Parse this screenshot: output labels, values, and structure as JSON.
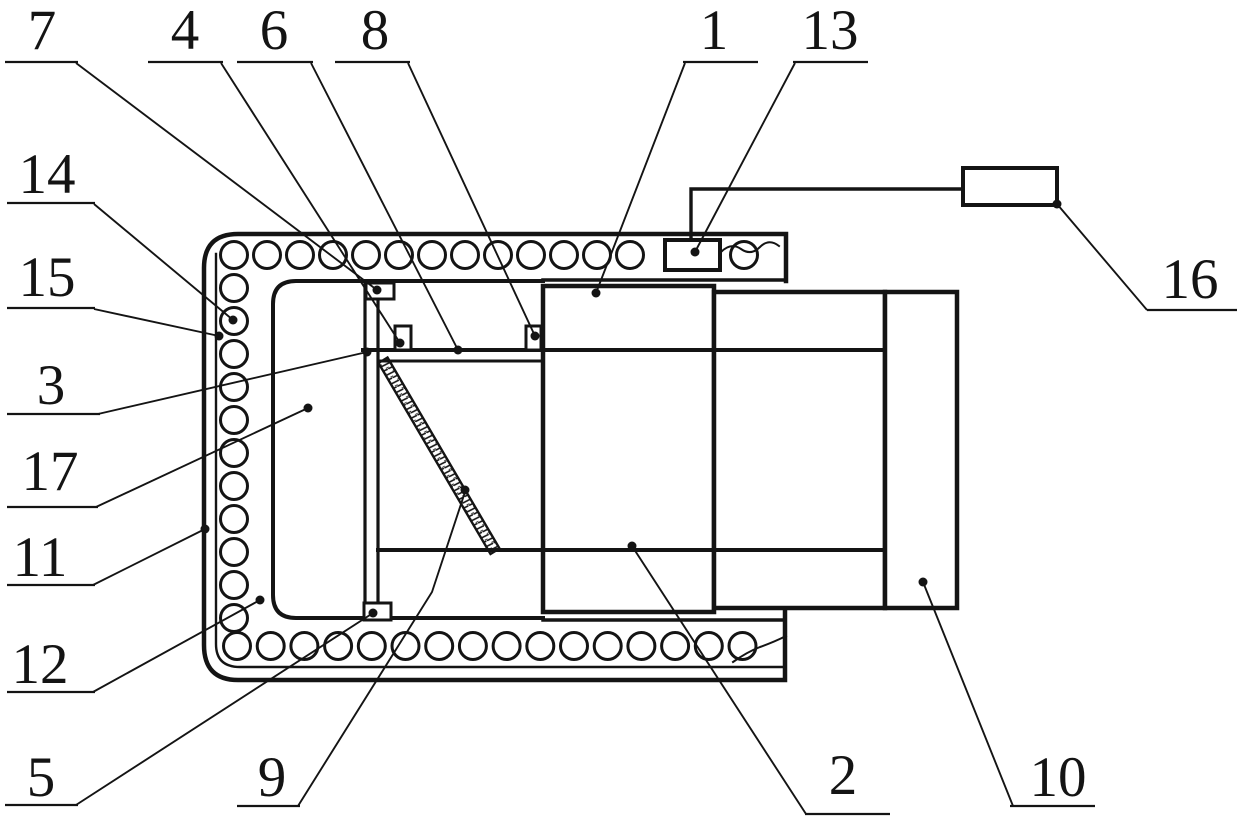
{
  "figure": {
    "kind": "patent-technical-drawing",
    "background_color": "#ffffff",
    "line_color": "#141414",
    "reference_numerals": [
      "1",
      "2",
      "3",
      "4",
      "5",
      "6",
      "7",
      "8",
      "9",
      "10",
      "11",
      "12",
      "13",
      "14",
      "15",
      "16",
      "17"
    ]
  },
  "labels": [
    {
      "ref": "7",
      "tx": 42,
      "ty": 49,
      "u": [
        5,
        78,
        62
      ],
      "leader": [
        [
          76,
          63
        ],
        [
          377,
          290
        ]
      ],
      "dot": [
        377,
        290
      ]
    },
    {
      "ref": "4",
      "tx": 185,
      "ty": 49,
      "u": [
        148,
        223,
        62
      ],
      "leader": [
        [
          221,
          63
        ],
        [
          400,
          343
        ]
      ],
      "dot": [
        400,
        343
      ]
    },
    {
      "ref": "6",
      "tx": 274,
      "ty": 49,
      "u": [
        237,
        313,
        62
      ],
      "leader": [
        [
          311,
          63
        ],
        [
          458,
          350
        ]
      ],
      "dot": [
        458,
        350
      ]
    },
    {
      "ref": "8",
      "tx": 375,
      "ty": 49,
      "u": [
        335,
        410,
        62
      ],
      "leader": [
        [
          408,
          63
        ],
        [
          535,
          336
        ]
      ],
      "dot": [
        535,
        336
      ]
    },
    {
      "ref": "1",
      "tx": 714,
      "ty": 49,
      "u": [
        683,
        758,
        62
      ],
      "leader": [
        [
          685,
          63
        ],
        [
          596,
          293
        ]
      ],
      "dot": [
        596,
        293
      ]
    },
    {
      "ref": "13",
      "tx": 830,
      "ty": 49,
      "u": [
        793,
        868,
        62
      ],
      "leader": [
        [
          795,
          63
        ],
        [
          695,
          252
        ]
      ],
      "dot": [
        695,
        252
      ]
    },
    {
      "ref": "14",
      "tx": 47,
      "ty": 193,
      "u": [
        7,
        95,
        203
      ],
      "leader": [
        [
          94,
          204
        ],
        [
          233,
          320
        ]
      ],
      "dot": [
        233,
        320
      ]
    },
    {
      "ref": "15",
      "tx": 47,
      "ty": 296,
      "u": [
        7,
        95,
        308
      ],
      "leader": [
        [
          94,
          309
        ],
        [
          219,
          336
        ]
      ],
      "dot": [
        219,
        336
      ]
    },
    {
      "ref": "3",
      "tx": 51,
      "ty": 404,
      "u": [
        7,
        100,
        414
      ],
      "leader": [
        [
          98,
          414
        ],
        [
          367,
          352
        ]
      ],
      "dot": [
        367,
        352
      ]
    },
    {
      "ref": "17",
      "tx": 50,
      "ty": 490,
      "u": [
        7,
        98,
        507
      ],
      "leader": [
        [
          96,
          507
        ],
        [
          308,
          408
        ]
      ],
      "dot": [
        308,
        408
      ]
    },
    {
      "ref": "11",
      "tx": 40,
      "ty": 576,
      "u": [
        7,
        95,
        585
      ],
      "leader": [
        [
          93,
          585
        ],
        [
          205,
          529
        ]
      ],
      "dot": [
        205,
        529
      ]
    },
    {
      "ref": "12",
      "tx": 40,
      "ty": 683,
      "u": [
        7,
        95,
        692
      ],
      "leader": [
        [
          93,
          692
        ],
        [
          260,
          600
        ]
      ],
      "dot": [
        260,
        600
      ]
    },
    {
      "ref": "5",
      "tx": 41,
      "ty": 796,
      "u": [
        5,
        78,
        805
      ],
      "leader": [
        [
          76,
          805
        ],
        [
          373,
          613
        ]
      ],
      "dot": [
        373,
        613
      ]
    },
    {
      "ref": "9",
      "tx": 272,
      "ty": 796,
      "u": [
        237,
        300,
        806
      ],
      "leader": [
        [
          298,
          806
        ],
        [
          432,
          592
        ],
        [
          465,
          492
        ]
      ],
      "dot": [
        465,
        490
      ]
    },
    {
      "ref": "2",
      "tx": 843,
      "ty": 794,
      "u": [
        805,
        890,
        814
      ],
      "leader": [
        [
          806,
          814
        ],
        [
          632,
          546
        ]
      ],
      "dot": [
        632,
        546
      ]
    },
    {
      "ref": "10",
      "tx": 1058,
      "ty": 796,
      "u": [
        1010,
        1095,
        806
      ],
      "leader": [
        [
          1013,
          806
        ],
        [
          923,
          582
        ]
      ],
      "dot": [
        923,
        582
      ]
    },
    {
      "ref": "16",
      "tx": 1190,
      "ty": 298,
      "u": [
        1147,
        1237,
        310
      ],
      "leader": [
        [
          1147,
          310
        ],
        [
          1057,
          204
        ]
      ],
      "dot": [
        1057,
        204
      ]
    }
  ]
}
